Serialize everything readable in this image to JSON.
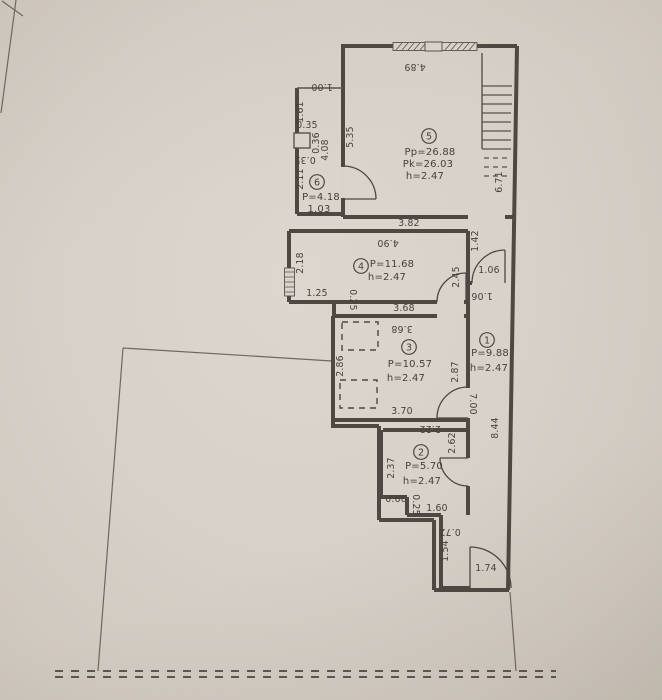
{
  "plan": {
    "type": "apartment-floor-plan",
    "rooms": [
      {
        "num": "1",
        "cx": 487,
        "cy": 340,
        "lines": [
          {
            "t": "P=9.88",
            "x": 490,
            "y": 356
          },
          {
            "t": "h=2.47",
            "x": 489,
            "y": 371
          }
        ]
      },
      {
        "num": "2",
        "cx": 421,
        "cy": 452,
        "lines": [
          {
            "t": "P=5.70",
            "x": 424,
            "y": 469
          },
          {
            "t": "h=2.47",
            "x": 422,
            "y": 484
          }
        ]
      },
      {
        "num": "3",
        "cx": 409,
        "cy": 347,
        "lines": [
          {
            "t": "P=10.57",
            "x": 410,
            "y": 367
          },
          {
            "t": "h=2.47",
            "x": 406,
            "y": 381
          }
        ]
      },
      {
        "num": "4",
        "cx": 361,
        "cy": 266,
        "lines": [
          {
            "t": "P=11.68",
            "x": 392,
            "y": 267
          },
          {
            "t": "h=2.47",
            "x": 387,
            "y": 280
          }
        ]
      },
      {
        "num": "5",
        "cx": 429,
        "cy": 136,
        "lines": [
          {
            "t": "Pp=26.88",
            "x": 430,
            "y": 155
          },
          {
            "t": "Pk=26.03",
            "x": 428,
            "y": 167
          },
          {
            "t": "h=2.47",
            "x": 425,
            "y": 179
          }
        ]
      },
      {
        "num": "6",
        "cx": 317,
        "cy": 182,
        "lines": [
          {
            "t": "P=4.18",
            "x": 321,
            "y": 200
          },
          {
            "t": "1.03",
            "x": 319,
            "y": 212
          }
        ]
      }
    ],
    "dimensions": [
      {
        "t": "4.89",
        "x": 415,
        "y": 64,
        "r": 180
      },
      {
        "t": "5.35",
        "x": 353,
        "y": 137,
        "r": -90
      },
      {
        "t": "6.71",
        "x": 502,
        "y": 182,
        "r": -90
      },
      {
        "t": "1.00",
        "x": 322,
        "y": 84,
        "r": 180
      },
      {
        "t": "3.82",
        "x": 409,
        "y": 226,
        "r": 0
      },
      {
        "t": "1.61",
        "x": 303,
        "y": 112,
        "r": -90
      },
      {
        "t": "0.35",
        "x": 307,
        "y": 128,
        "r": 0
      },
      {
        "t": "0.36",
        "x": 319,
        "y": 143,
        "r": -90
      },
      {
        "t": "0.35",
        "x": 305,
        "y": 157,
        "r": 180
      },
      {
        "t": "4.08",
        "x": 328,
        "y": 150,
        "r": -90
      },
      {
        "t": "2.11",
        "x": 303,
        "y": 179,
        "r": -90
      },
      {
        "t": "4.90",
        "x": 388,
        "y": 240,
        "r": 180
      },
      {
        "t": "2.18",
        "x": 303,
        "y": 263,
        "r": -90
      },
      {
        "t": "2.45",
        "x": 459,
        "y": 277,
        "r": -90
      },
      {
        "t": "1.42",
        "x": 478,
        "y": 241,
        "r": -90
      },
      {
        "t": "1.06",
        "x": 489,
        "y": 273,
        "r": 0
      },
      {
        "t": "1.06",
        "x": 482,
        "y": 293,
        "r": 180
      },
      {
        "t": "1.25",
        "x": 317,
        "y": 296,
        "r": 0
      },
      {
        "t": "0.25",
        "x": 350,
        "y": 300,
        "r": 90
      },
      {
        "t": "3.68",
        "x": 404,
        "y": 311,
        "r": 0
      },
      {
        "t": "3.68",
        "x": 402,
        "y": 326,
        "r": 180
      },
      {
        "t": "2.86",
        "x": 343,
        "y": 366,
        "r": -90
      },
      {
        "t": "2.87",
        "x": 458,
        "y": 372,
        "r": -90
      },
      {
        "t": "3.70",
        "x": 402,
        "y": 414,
        "r": 0
      },
      {
        "t": "7.00",
        "x": 470,
        "y": 404,
        "r": 90
      },
      {
        "t": "8.44",
        "x": 498,
        "y": 428,
        "r": -90
      },
      {
        "t": "2.22",
        "x": 430,
        "y": 426,
        "r": 180
      },
      {
        "t": "2.37",
        "x": 394,
        "y": 468,
        "r": -90
      },
      {
        "t": "2.62",
        "x": 455,
        "y": 443,
        "r": -90
      },
      {
        "t": "0.66",
        "x": 396,
        "y": 502,
        "r": 0
      },
      {
        "t": "0.25",
        "x": 413,
        "y": 505,
        "r": 90
      },
      {
        "t": "1.60",
        "x": 437,
        "y": 511,
        "r": 0
      },
      {
        "t": "0.72",
        "x": 450,
        "y": 529,
        "r": 180
      },
      {
        "t": "1.54",
        "x": 448,
        "y": 551,
        "r": -90
      },
      {
        "t": "1.74",
        "x": 486,
        "y": 571,
        "r": 0
      }
    ],
    "colors": {
      "paper": "#d7d1c9",
      "wall": "#4d4842",
      "thin_line": "#57524b",
      "text": "#45413b",
      "boundary": "#6d675f"
    }
  }
}
